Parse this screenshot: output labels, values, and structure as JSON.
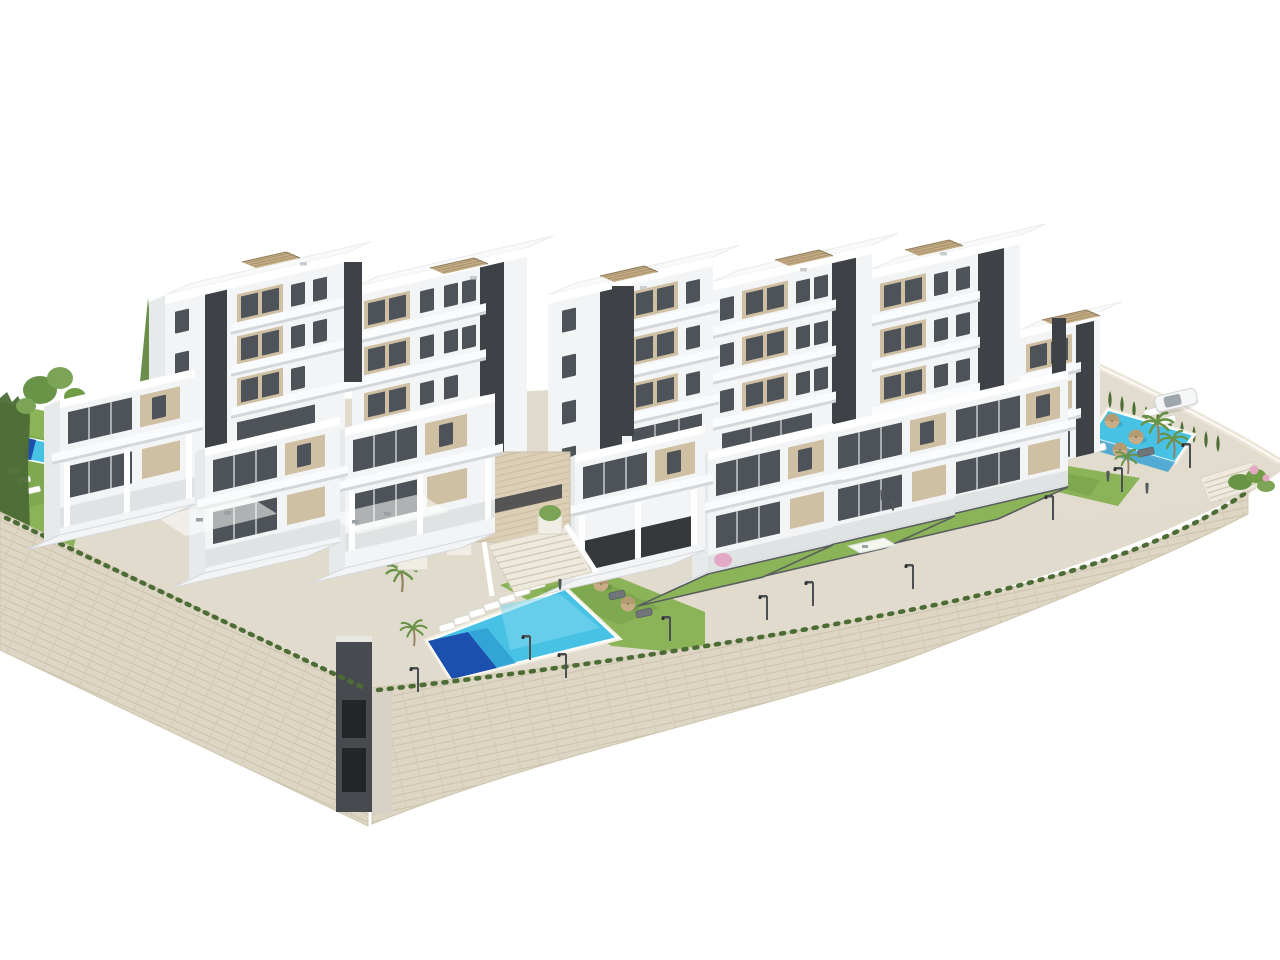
{
  "meta": {
    "title": "New-build residential complex — aerial 3D render",
    "description": "Aerial 3D architectural rendering of a modern white cubic apartment complex built over tall dry-stone retaining walls, with roof pergolas, glass balconies, private lawns, a large central community pool with sun loungers and parasols, a second walled pool terrace with palm trees and a parked car, cypress hedges, street lamps and a few people, all on a plain white background"
  },
  "scene": {
    "colors": {
      "bg": "#ffffff",
      "paving": "#e1dbcd",
      "paving-light": "#eae4d6",
      "wall-stone": "#ded6c4",
      "wall-line": "#c8bda6",
      "bldg-front": "#f3f4f5",
      "bldg-side": "#e7eaeb",
      "bldg-top": "#f8f9f9",
      "fascia": "#fafbfc",
      "shadow": "#d4d7d9",
      "panel-tan": "#cfbfa3",
      "panel-tan-dark": "#bba87f",
      "glass": "#4d5358",
      "core": "#3e4246",
      "lawn": "#8ab457",
      "lawn-dark": "#6f9c45",
      "hedge": "#4c6c35",
      "tree": "#699447",
      "trunk": "#95805f",
      "pool": "#47c2e5",
      "pool-mid": "#2f9fd4",
      "pool-deep": "#1d50ae",
      "rim": "#f4f0e4",
      "umbrella": "#c6ad85",
      "umbrella-dark": "#a98f66",
      "lamp": "#4b4f52",
      "people": "#55585b",
      "car": "#f5f6f6",
      "flower-pink": "#e5a8c6",
      "travertine": "#dccfb6",
      "travertine-line": "#c4b598"
    },
    "buildings": {
      "style": "modern white cubic apartment blocks with beige stucco panels, dark glazing and dark stair cores",
      "back_row_blocks": 6,
      "front_row_villas": 7,
      "max_floors": 4,
      "features": [
        "rooftop slatted pergolas",
        "glass-railed balconies",
        "roof terraces with furniture",
        "central travertine-clad entrance with wide staircase",
        "underground garage shaft at wall corner"
      ]
    },
    "landscape": {
      "retaining_walls": [
        "tall left dry-stone wall",
        "long curved front dry-stone wall tapering to the right",
        "low right perimeter wall"
      ],
      "pools": [
        {
          "id": "central-community-pool",
          "note": "large parallelogram pool with dark deep end, loungers and 3 parasols"
        },
        {
          "id": "east-community-pool",
          "note": "walled terrace pool with palms, parasols, cypress hedge and parked white car"
        },
        {
          "id": "private-plunge-pool",
          "note": "small pool on left private lawn"
        }
      ],
      "lawns": 7,
      "palm_trees": 5,
      "cypress_hedges": 3,
      "street_lamps": 10,
      "sun_loungers": 15,
      "parasols": 6,
      "people": 6,
      "cars": 1,
      "flower_accents": 3
    }
  }
}
